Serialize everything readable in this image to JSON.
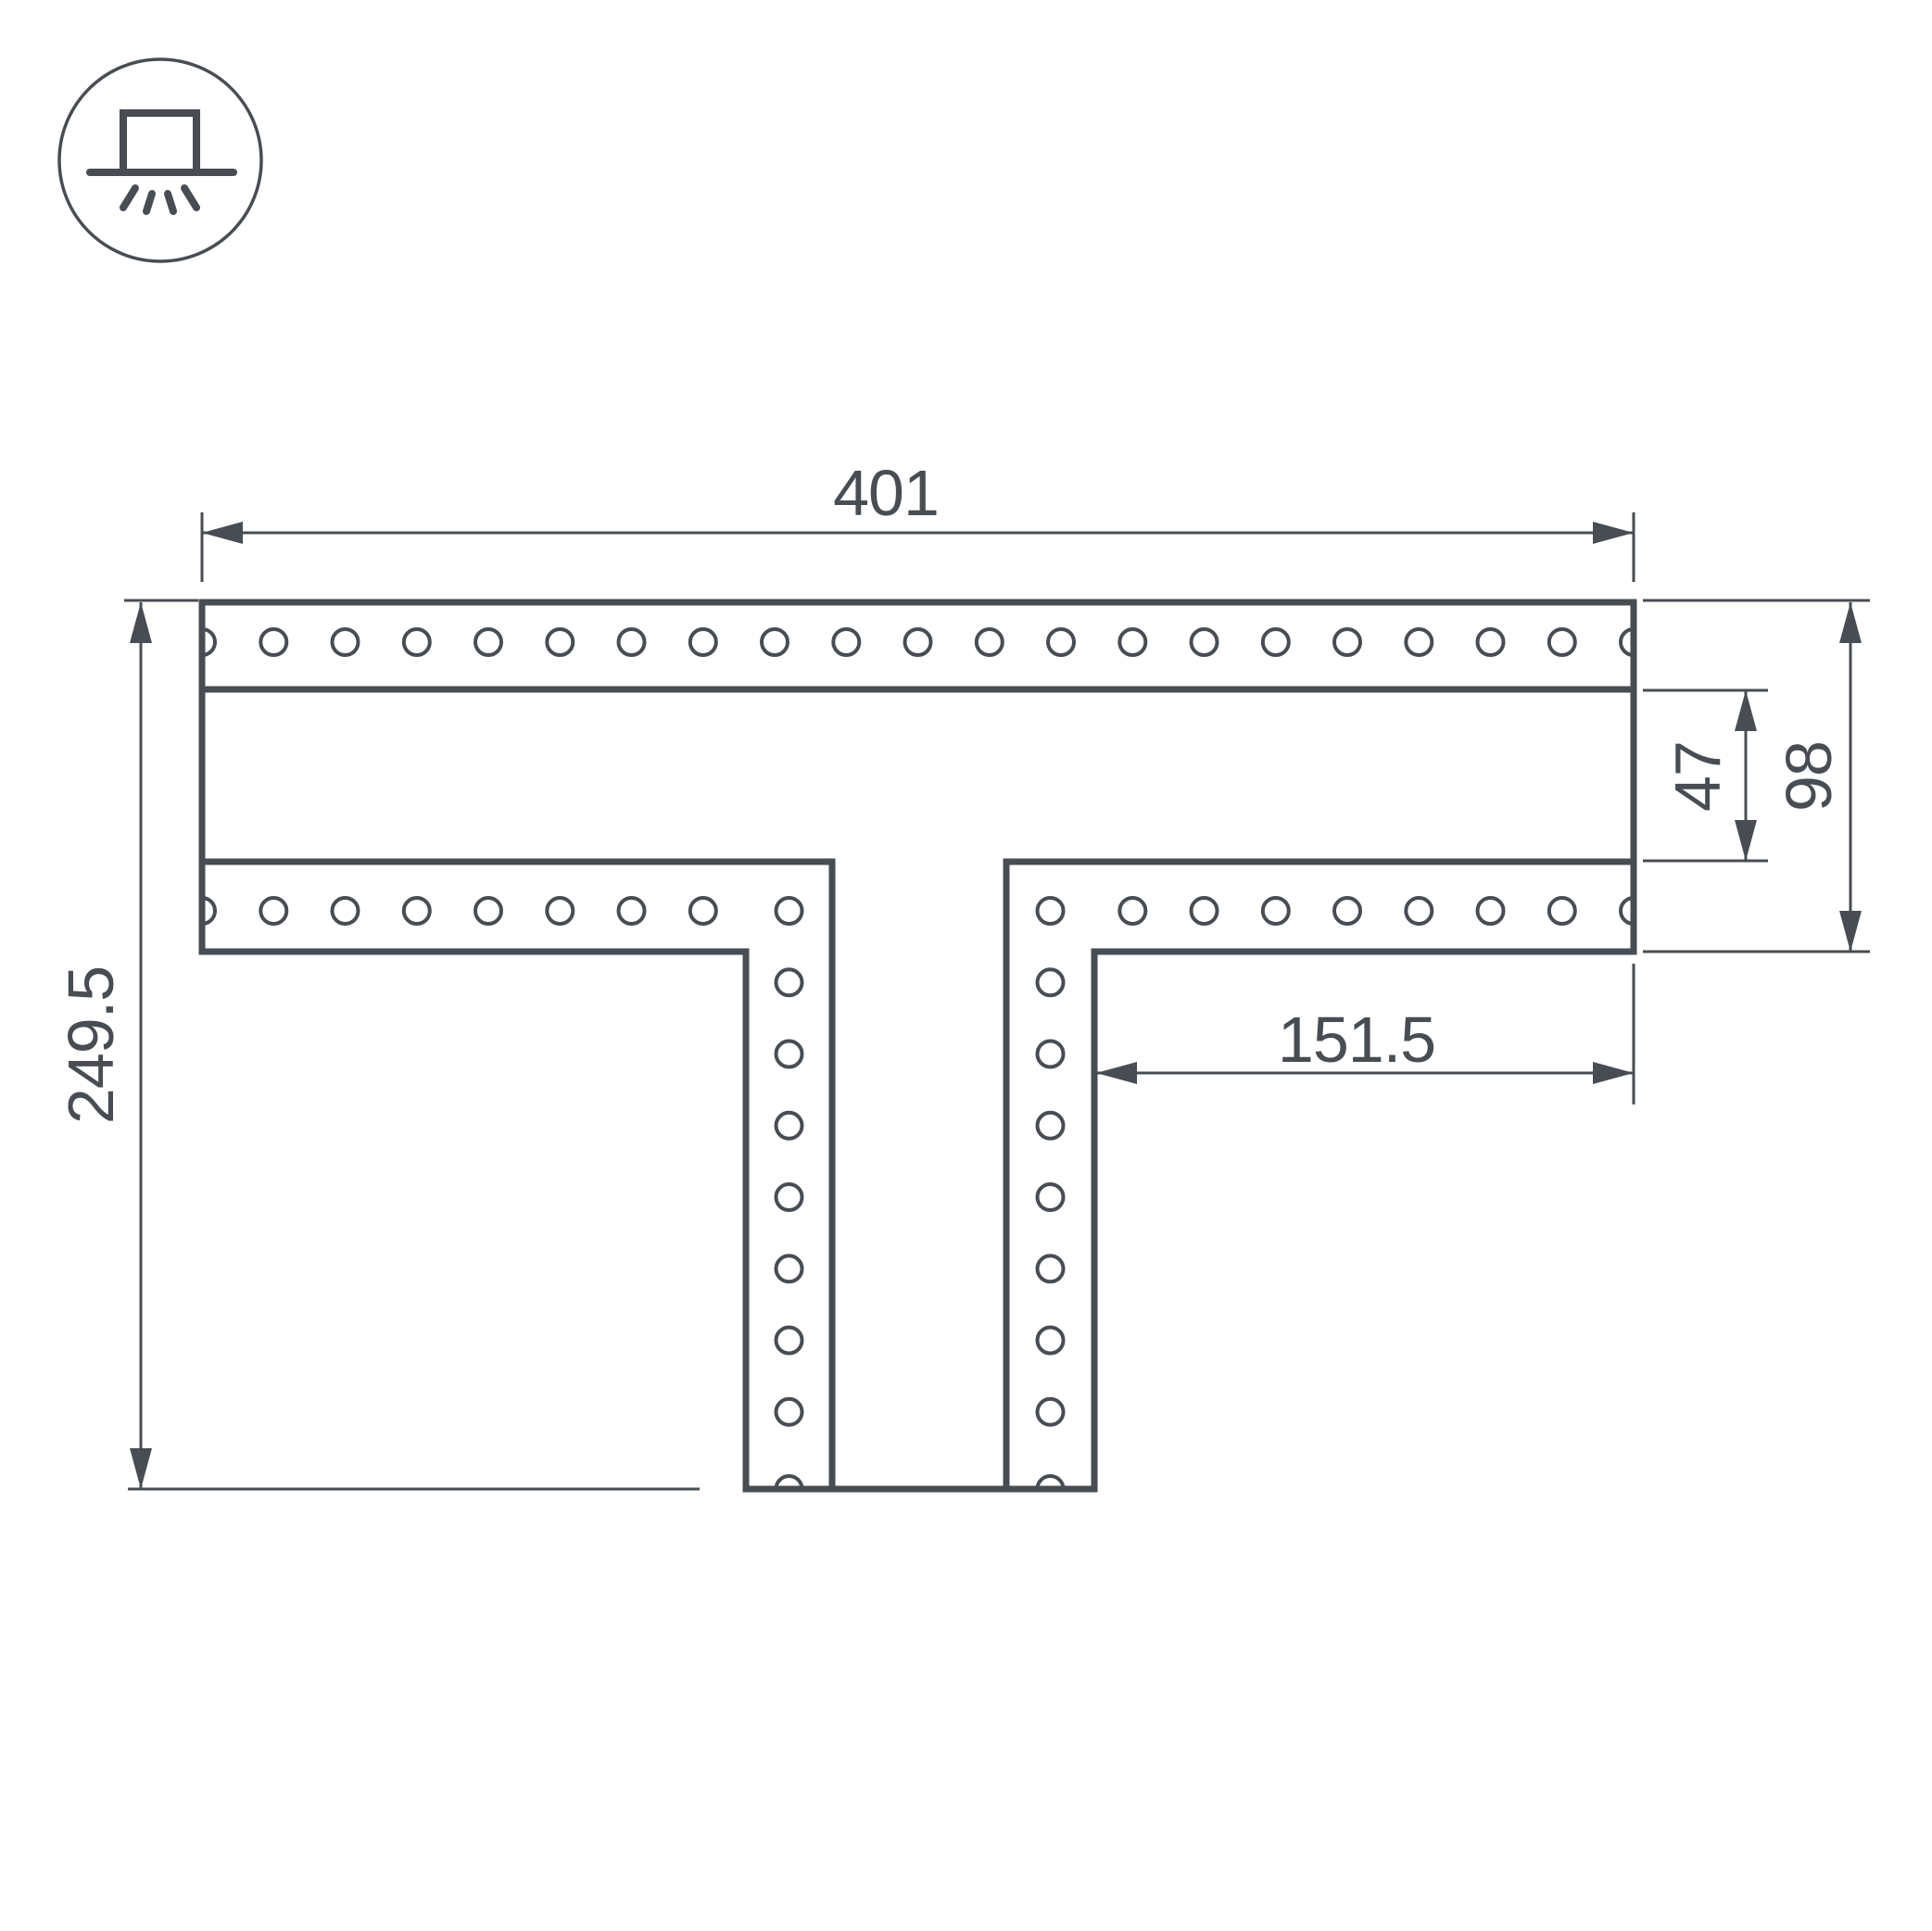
{
  "colors": {
    "ink": "#474d52",
    "background": "#ffffff"
  },
  "icon": {
    "name": "recessed-luminaire-symbol"
  },
  "dimensions": {
    "total_width": {
      "label": "401"
    },
    "total_height": {
      "label": "249.5"
    },
    "channel_width": {
      "label": "47"
    },
    "flange_height": {
      "label": "98"
    },
    "branch_length": {
      "label": "151.5"
    }
  },
  "drawing": {
    "hole_radius": 14,
    "holes": [
      [
        218,
        693
      ],
      [
        295.3,
        693
      ],
      [
        372.5,
        693
      ],
      [
        449.8,
        693
      ],
      [
        527,
        693
      ],
      [
        604.3,
        693
      ],
      [
        681.5,
        693
      ],
      [
        758.8,
        693
      ],
      [
        836,
        693
      ],
      [
        913.3,
        693
      ],
      [
        990.5,
        693
      ],
      [
        1067.8,
        693
      ],
      [
        1145,
        693
      ],
      [
        1222.3,
        693
      ],
      [
        1299.5,
        693
      ],
      [
        1376.8,
        693
      ],
      [
        1454,
        693
      ],
      [
        1531.3,
        693
      ],
      [
        1608.5,
        693
      ],
      [
        1685.8,
        693
      ],
      [
        1763,
        693
      ],
      [
        218,
        983
      ],
      [
        295.3,
        983
      ],
      [
        372.5,
        983
      ],
      [
        449.8,
        983
      ],
      [
        527,
        983
      ],
      [
        604.3,
        983
      ],
      [
        681.5,
        983
      ],
      [
        758.8,
        983
      ],
      [
        851.5,
        983
      ],
      [
        1133.5,
        983
      ],
      [
        1222.3,
        983
      ],
      [
        1299.5,
        983
      ],
      [
        1376.8,
        983
      ],
      [
        1454,
        983
      ],
      [
        1531.3,
        983
      ],
      [
        1608.5,
        983
      ],
      [
        1685.8,
        983
      ],
      [
        1763,
        983
      ],
      [
        851.5,
        1060.3
      ],
      [
        851.5,
        1137.5
      ],
      [
        851.5,
        1214.8
      ],
      [
        851.5,
        1292
      ],
      [
        851.5,
        1369.3
      ],
      [
        851.5,
        1446.5
      ],
      [
        851.5,
        1523.8
      ],
      [
        851.5,
        1607
      ],
      [
        1133.5,
        1060.3
      ],
      [
        1133.5,
        1137.5
      ],
      [
        1133.5,
        1214.8
      ],
      [
        1133.5,
        1292
      ],
      [
        1133.5,
        1369.3
      ],
      [
        1133.5,
        1446.5
      ],
      [
        1133.5,
        1523.8
      ],
      [
        1133.5,
        1607
      ]
    ]
  }
}
